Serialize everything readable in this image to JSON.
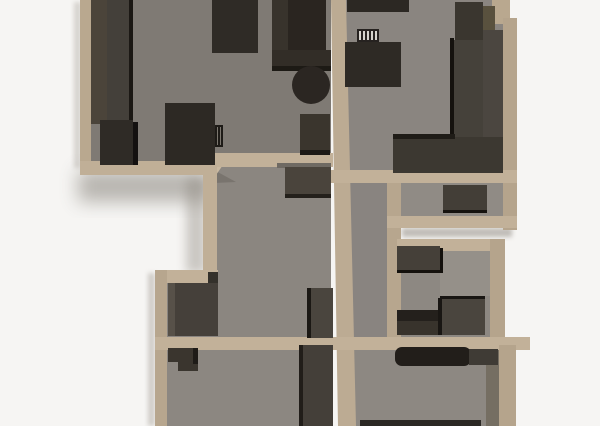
{
  "scene": {
    "width": 600,
    "height": 426,
    "background": "#f6f5f3",
    "wall_color": "#bcab93",
    "floor_color": "#8a8580",
    "furniture_color": "#3a352e"
  },
  "shapes": [
    {
      "name": "background",
      "type": "rect",
      "x": 0,
      "y": 0,
      "w": 600,
      "h": 426,
      "fill": "#f6f5f3"
    },
    {
      "name": "shadow-below-living-room",
      "type": "rect",
      "x": 78,
      "y": 170,
      "w": 134,
      "h": 32,
      "fill": "#6d675f",
      "opacity": 0.45,
      "blur": "blur-lg"
    },
    {
      "name": "shadow-door-exterior",
      "type": "rect",
      "x": 186,
      "y": 178,
      "w": 20,
      "h": 95,
      "fill": "#8a847b",
      "opacity": 0.4,
      "blur": "blur-md"
    },
    {
      "name": "shadow-right-gap",
      "type": "rect",
      "x": 402,
      "y": 228,
      "w": 110,
      "h": 9,
      "fill": "#8a847b",
      "opacity": 0.5,
      "blur": "blur-sm"
    },
    {
      "name": "shadow-left-bottom-block",
      "type": "rect",
      "x": 148,
      "y": 273,
      "w": 7,
      "h": 153,
      "fill": "#a9a49c",
      "opacity": 0.5,
      "blur": "blur-sm"
    },
    {
      "name": "shadow-left-living-wall",
      "type": "rect",
      "x": 74,
      "y": 2,
      "w": 7,
      "h": 166,
      "fill": "#b5b0a9",
      "opacity": 0.5,
      "blur": "blur-sm"
    },
    {
      "name": "floor-living-room",
      "type": "rect",
      "x": 91,
      "y": 0,
      "w": 240,
      "h": 161,
      "fill": "#7f7a74"
    },
    {
      "name": "floor-kitchen",
      "type": "rect",
      "x": 346,
      "y": 0,
      "w": 157,
      "h": 170,
      "fill": "#8a8580"
    },
    {
      "name": "floor-hall-center",
      "type": "rect",
      "x": 217,
      "y": 160,
      "w": 114,
      "h": 177,
      "fill": "#8b8680"
    },
    {
      "name": "floor-corridor",
      "type": "rect",
      "x": 346,
      "y": 183,
      "w": 42,
      "h": 157,
      "fill": "#898480"
    },
    {
      "name": "floor-room-right-mid",
      "type": "rect",
      "x": 401,
      "y": 183,
      "w": 102,
      "h": 33,
      "fill": "#908b85"
    },
    {
      "name": "floor-room-lower-right",
      "type": "rect",
      "x": 399,
      "y": 250,
      "w": 91,
      "h": 87,
      "fill": "#8d8882"
    },
    {
      "name": "floor-lower-right-light",
      "type": "rect",
      "x": 440,
      "y": 250,
      "w": 50,
      "h": 46,
      "fill": "#959089"
    },
    {
      "name": "floor-closet-bottom-left",
      "type": "rect",
      "x": 167,
      "y": 283,
      "w": 50,
      "h": 54,
      "fill": "#8a8580"
    },
    {
      "name": "floor-room-bottom-left",
      "type": "rect",
      "x": 167,
      "y": 350,
      "w": 164,
      "h": 76,
      "fill": "#8c8781"
    },
    {
      "name": "floor-room-bottom-right",
      "type": "rect",
      "x": 346,
      "y": 350,
      "w": 151,
      "h": 76,
      "fill": "#8d8882"
    },
    {
      "name": "floor-shade-bottom-right",
      "type": "rect",
      "x": 486,
      "y": 350,
      "w": 13,
      "h": 76,
      "fill": "#756e62"
    },
    {
      "name": "floor-door-shadow",
      "type": "polygon",
      "points": "214,170 236,182 214,183",
      "fill": "#6b665f",
      "opacity": 0.55
    },
    {
      "name": "wall-living-left",
      "type": "rect",
      "x": 80,
      "y": 0,
      "w": 11,
      "h": 175,
      "fill": "#b9a88f"
    },
    {
      "name": "wall-living-bottom",
      "type": "rect",
      "x": 80,
      "y": 161,
      "w": 132,
      "h": 14,
      "fill": "#c0af97"
    },
    {
      "name": "wall-door-leaf",
      "type": "polygon",
      "points": "208,176 218,154 227,159 214,178",
      "fill": "#c9b8a0"
    },
    {
      "name": "wall-living-bottom-right",
      "type": "rect",
      "x": 214,
      "y": 153,
      "w": 119,
      "h": 14,
      "fill": "#c2b199"
    },
    {
      "name": "wall-spine",
      "type": "polygon",
      "points": "331,0 346,0 356,426 338,426",
      "fill": "#bcab93"
    },
    {
      "name": "wall-hall-left",
      "type": "rect",
      "x": 203,
      "y": 163,
      "w": 14,
      "h": 120,
      "fill": "#c0af97"
    },
    {
      "name": "wall-kitchen-right-step",
      "type": "rect",
      "x": 492,
      "y": 0,
      "w": 18,
      "h": 24,
      "fill": "#b9a88f"
    },
    {
      "name": "wall-kitchen-right",
      "type": "rect",
      "x": 503,
      "y": 18,
      "w": 14,
      "h": 212,
      "fill": "#b5a48c"
    },
    {
      "name": "wall-kitchen-bottom",
      "type": "rect",
      "x": 331,
      "y": 170,
      "w": 186,
      "h": 13,
      "fill": "#c2b199"
    },
    {
      "name": "wall-corridor-right",
      "type": "rect",
      "x": 387,
      "y": 183,
      "w": 14,
      "h": 167,
      "fill": "#b7a68e"
    },
    {
      "name": "wall-right-mid-bottom",
      "type": "rect",
      "x": 387,
      "y": 216,
      "w": 130,
      "h": 12,
      "fill": "#c2b199"
    },
    {
      "name": "wall-lower-right-top",
      "type": "rect",
      "x": 397,
      "y": 239,
      "w": 108,
      "h": 12,
      "fill": "#c2b199"
    },
    {
      "name": "wall-lower-right-right",
      "type": "rect",
      "x": 490,
      "y": 239,
      "w": 15,
      "h": 111,
      "fill": "#b5a48c"
    },
    {
      "name": "wall-bottom-left-top",
      "type": "rect",
      "x": 155,
      "y": 270,
      "w": 63,
      "h": 13,
      "fill": "#c2b199"
    },
    {
      "name": "wall-bottom-left-left",
      "type": "rect",
      "x": 155,
      "y": 270,
      "w": 12,
      "h": 156,
      "fill": "#b7a68e"
    },
    {
      "name": "wall-bottom-long",
      "type": "rect",
      "x": 155,
      "y": 337,
      "w": 375,
      "h": 13,
      "fill": "#c2b199"
    },
    {
      "name": "wall-bottom-right-right",
      "type": "rect",
      "x": 499,
      "y": 345,
      "w": 17,
      "h": 81,
      "fill": "#b5a48c"
    },
    {
      "name": "furniture-wardrobe-left-panel",
      "type": "rect",
      "x": 91,
      "y": 0,
      "w": 16,
      "h": 124,
      "fill": "#4b443a"
    },
    {
      "name": "furniture-wardrobe-body",
      "type": "rect",
      "x": 107,
      "y": 0,
      "w": 23,
      "h": 124,
      "fill": "#44403a"
    },
    {
      "name": "furniture-wardrobe-edge",
      "type": "rect",
      "x": 129,
      "y": 0,
      "w": 4,
      "h": 124,
      "fill": "#1b1814"
    },
    {
      "name": "furniture-sideboard",
      "type": "rect",
      "x": 100,
      "y": 120,
      "w": 33,
      "h": 45,
      "fill": "#2f2b26"
    },
    {
      "name": "furniture-sideboard-edge",
      "type": "rect",
      "x": 133,
      "y": 122,
      "w": 5,
      "h": 43,
      "fill": "#141110"
    },
    {
      "name": "furniture-desk",
      "type": "rect",
      "x": 165,
      "y": 103,
      "w": 50,
      "h": 62,
      "fill": "#2d2924"
    },
    {
      "name": "furniture-desk-panel",
      "type": "rect",
      "x": 215,
      "y": 125,
      "w": 8,
      "h": 22,
      "fill": "#1e1b17"
    },
    {
      "name": "furniture-desk-panel-line-1",
      "type": "rect",
      "x": 217,
      "y": 127,
      "w": 1,
      "h": 18,
      "fill": "#7c776f"
    },
    {
      "name": "furniture-desk-panel-line-2",
      "type": "rect",
      "x": 220,
      "y": 127,
      "w": 1,
      "h": 18,
      "fill": "#7c776f"
    },
    {
      "name": "furniture-cabinet-top",
      "type": "rect",
      "x": 212,
      "y": 0,
      "w": 46,
      "h": 53,
      "fill": "#2f2b26"
    },
    {
      "name": "furniture-sofa-back",
      "type": "rect",
      "x": 272,
      "y": 0,
      "w": 18,
      "h": 57,
      "fill": "#38332c"
    },
    {
      "name": "furniture-sofa-seat",
      "type": "rect",
      "x": 288,
      "y": 0,
      "w": 38,
      "h": 50,
      "fill": "#2a2520"
    },
    {
      "name": "furniture-sofa-arm",
      "type": "rect",
      "x": 272,
      "y": 50,
      "w": 59,
      "h": 20,
      "fill": "#322d27"
    },
    {
      "name": "furniture-sofa-arm-edge",
      "type": "rect",
      "x": 272,
      "y": 66,
      "w": 59,
      "h": 5,
      "fill": "#1d1a15"
    },
    {
      "name": "furniture-round-table",
      "type": "circle",
      "cx": 311,
      "cy": 85,
      "r": 19,
      "fill": "#2b2622"
    },
    {
      "name": "furniture-tv-stand",
      "type": "rect",
      "x": 300,
      "y": 114,
      "w": 30,
      "h": 41,
      "fill": "#3a352d"
    },
    {
      "name": "furniture-tv-stand-edge",
      "type": "rect",
      "x": 300,
      "y": 150,
      "w": 30,
      "h": 5,
      "fill": "#1c1915"
    },
    {
      "name": "furniture-kitchen-top-cabinet",
      "type": "rect",
      "x": 347,
      "y": 0,
      "w": 62,
      "h": 12,
      "fill": "#2c2823"
    },
    {
      "name": "furniture-piano-keys",
      "type": "rect",
      "x": 357,
      "y": 29,
      "w": 22,
      "h": 13,
      "fill": "#262220"
    },
    {
      "name": "furniture-piano-key-1",
      "type": "rect",
      "x": 359,
      "y": 31,
      "w": 2,
      "h": 9,
      "fill": "#d6d3cd"
    },
    {
      "name": "furniture-piano-key-2",
      "type": "rect",
      "x": 363,
      "y": 31,
      "w": 2,
      "h": 9,
      "fill": "#d6d3cd"
    },
    {
      "name": "furniture-piano-key-3",
      "type": "rect",
      "x": 367,
      "y": 31,
      "w": 2,
      "h": 9,
      "fill": "#d6d3cd"
    },
    {
      "name": "furniture-piano-key-4",
      "type": "rect",
      "x": 371,
      "y": 31,
      "w": 2,
      "h": 9,
      "fill": "#d6d3cd"
    },
    {
      "name": "furniture-piano-key-5",
      "type": "rect",
      "x": 375,
      "y": 31,
      "w": 2,
      "h": 9,
      "fill": "#d6d3cd"
    },
    {
      "name": "furniture-piano-body",
      "type": "rect",
      "x": 345,
      "y": 42,
      "w": 56,
      "h": 45,
      "fill": "#2e2a25"
    },
    {
      "name": "furniture-fridge",
      "type": "rect",
      "x": 455,
      "y": 2,
      "w": 28,
      "h": 41,
      "fill": "#3a362f"
    },
    {
      "name": "furniture-counter-wood-top",
      "type": "rect",
      "x": 483,
      "y": 6,
      "w": 12,
      "h": 27,
      "fill": "#59513e"
    },
    {
      "name": "furniture-counter-left-col",
      "type": "rect",
      "x": 453,
      "y": 40,
      "w": 30,
      "h": 132,
      "fill": "#45413a"
    },
    {
      "name": "furniture-counter-right-col",
      "type": "rect",
      "x": 483,
      "y": 30,
      "w": 20,
      "h": 142,
      "fill": "#4b4640"
    },
    {
      "name": "furniture-counter-edge",
      "type": "rect",
      "x": 450,
      "y": 38,
      "w": 4,
      "h": 134,
      "fill": "#15120e"
    },
    {
      "name": "furniture-counter-arm",
      "type": "rect",
      "x": 393,
      "y": 137,
      "w": 110,
      "h": 36,
      "fill": "#3c3831"
    },
    {
      "name": "furniture-counter-arm-edge",
      "type": "rect",
      "x": 393,
      "y": 134,
      "w": 62,
      "h": 5,
      "fill": "#1f1c17"
    },
    {
      "name": "furniture-dresser-right-mid",
      "type": "rect",
      "x": 443,
      "y": 185,
      "w": 44,
      "h": 27,
      "fill": "#433e37"
    },
    {
      "name": "furniture-dresser-right-mid-edge",
      "type": "rect",
      "x": 443,
      "y": 210,
      "w": 44,
      "h": 3,
      "fill": "#16130f"
    },
    {
      "name": "furniture-shelf-shadow",
      "type": "rect",
      "x": 277,
      "y": 163,
      "w": 54,
      "h": 5,
      "fill": "#6f6a63"
    },
    {
      "name": "furniture-shelf-hall",
      "type": "rect",
      "x": 285,
      "y": 167,
      "w": 46,
      "h": 31,
      "fill": "#4a443c"
    },
    {
      "name": "furniture-shelf-hall-edge",
      "type": "rect",
      "x": 285,
      "y": 194,
      "w": 46,
      "h": 4,
      "fill": "#24201b"
    },
    {
      "name": "furniture-wardrobe-hall",
      "type": "rect",
      "x": 310,
      "y": 288,
      "w": 23,
      "h": 50,
      "fill": "#4a453e"
    },
    {
      "name": "furniture-wardrobe-hall-edge",
      "type": "rect",
      "x": 307,
      "y": 288,
      "w": 4,
      "h": 50,
      "fill": "#1b1814"
    },
    {
      "name": "furniture-corner-block",
      "type": "rect",
      "x": 208,
      "y": 272,
      "w": 10,
      "h": 11,
      "fill": "#34312b"
    },
    {
      "name": "furniture-closet-wardrobe-side",
      "type": "rect",
      "x": 168,
      "y": 283,
      "w": 7,
      "h": 53,
      "fill": "#575149"
    },
    {
      "name": "furniture-closet-wardrobe",
      "type": "rect",
      "x": 175,
      "y": 283,
      "w": 43,
      "h": 53,
      "fill": "#45403a"
    },
    {
      "name": "furniture-lr-dresser",
      "type": "rect",
      "x": 397,
      "y": 246,
      "w": 43,
      "h": 26,
      "fill": "#454039"
    },
    {
      "name": "furniture-lr-dresser-edge-bottom",
      "type": "rect",
      "x": 397,
      "y": 270,
      "w": 46,
      "h": 3,
      "fill": "#14110d"
    },
    {
      "name": "furniture-lr-dresser-edge-right",
      "type": "rect",
      "x": 440,
      "y": 248,
      "w": 3,
      "h": 25,
      "fill": "#14110d"
    },
    {
      "name": "furniture-lr-lowbox-top",
      "type": "rect",
      "x": 397,
      "y": 310,
      "w": 45,
      "h": 13,
      "fill": "#24201c"
    },
    {
      "name": "furniture-lr-lowbox",
      "type": "rect",
      "x": 397,
      "y": 321,
      "w": 45,
      "h": 14,
      "fill": "#38332c"
    },
    {
      "name": "furniture-lr-box",
      "type": "rect",
      "x": 440,
      "y": 296,
      "w": 45,
      "h": 39,
      "fill": "#4a453e"
    },
    {
      "name": "furniture-lr-box-edge-top",
      "type": "rect",
      "x": 440,
      "y": 296,
      "w": 45,
      "h": 3,
      "fill": "#191613"
    },
    {
      "name": "furniture-lr-box-edge-left",
      "type": "rect",
      "x": 438,
      "y": 298,
      "w": 4,
      "h": 37,
      "fill": "#191613"
    },
    {
      "name": "furniture-bl-box",
      "type": "polygon",
      "points": "168,348 198,348 198,371 178,371 178,362 168,362",
      "fill": "#3a352e"
    },
    {
      "name": "furniture-bl-box-edge",
      "type": "rect",
      "x": 193,
      "y": 348,
      "w": 5,
      "h": 16,
      "fill": "#1e1b17"
    },
    {
      "name": "furniture-bl-column",
      "type": "rect",
      "x": 302,
      "y": 345,
      "w": 31,
      "h": 81,
      "fill": "#443f39"
    },
    {
      "name": "furniture-bl-column-edge",
      "type": "rect",
      "x": 299,
      "y": 345,
      "w": 4,
      "h": 81,
      "fill": "#211d19"
    },
    {
      "name": "furniture-br-sofa",
      "type": "rect",
      "x": 395,
      "y": 347,
      "w": 76,
      "h": 19,
      "rx": 7,
      "fill": "#221e1a"
    },
    {
      "name": "furniture-br-sofa-ext",
      "type": "rect",
      "x": 469,
      "y": 349,
      "w": 29,
      "h": 16,
      "fill": "#3f3b35"
    },
    {
      "name": "furniture-br-bottom-strip",
      "type": "rect",
      "x": 360,
      "y": 420,
      "w": 121,
      "h": 6,
      "fill": "#2b2824"
    }
  ]
}
